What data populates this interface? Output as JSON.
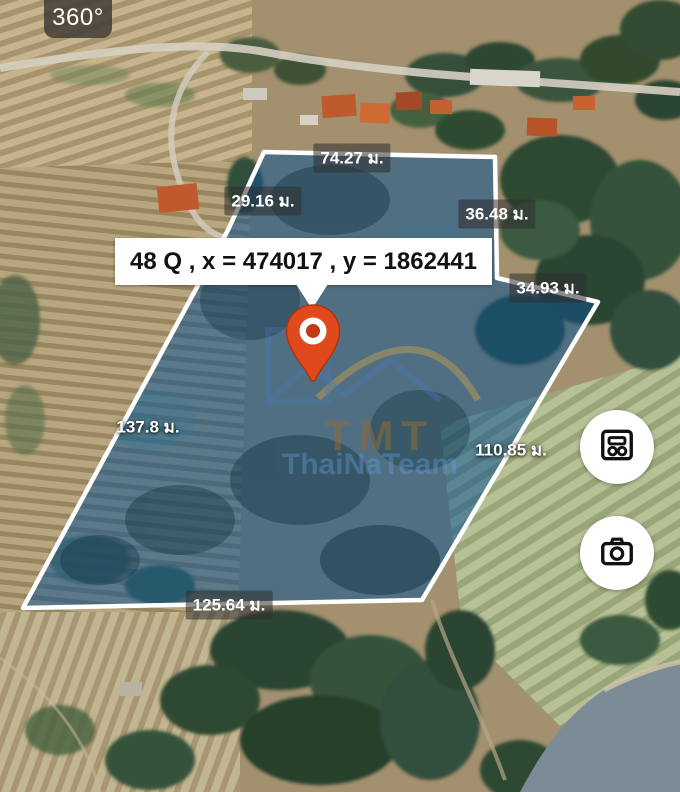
{
  "view": {
    "badge_360": "360°",
    "coordinate_label": "48 Q , x = 474017 , y = 1862441"
  },
  "measurements": [
    {
      "position": "top",
      "text": "74.27 ม."
    },
    {
      "position": "upper-left",
      "text": "29.16 ม."
    },
    {
      "position": "upper-right",
      "text": "36.48 ม."
    },
    {
      "position": "right-upper",
      "text": "34.93 ม."
    },
    {
      "position": "left",
      "text": "137.8 ม."
    },
    {
      "position": "right-lower",
      "text": "110.85 ม."
    },
    {
      "position": "bottom",
      "text": "125.64 ม."
    }
  ],
  "watermark": {
    "line1": "TMT",
    "line2": "ThaiNaTeam"
  },
  "controls": {
    "buttons": [
      {
        "icon": "measurement-panel-icon"
      },
      {
        "icon": "camera-icon"
      }
    ]
  },
  "colors": {
    "plot_outline": "#ffffff",
    "plot_fill": "rgba(14,84,146,0.55)",
    "pin": "#e0491c",
    "label_box_bg": "#ffffff",
    "label_text": "#111111",
    "measure_badge_bg": "rgba(45,45,45,0.55)",
    "watermark_gold": "#c9a14e",
    "watermark_blue": "#609cd6"
  }
}
